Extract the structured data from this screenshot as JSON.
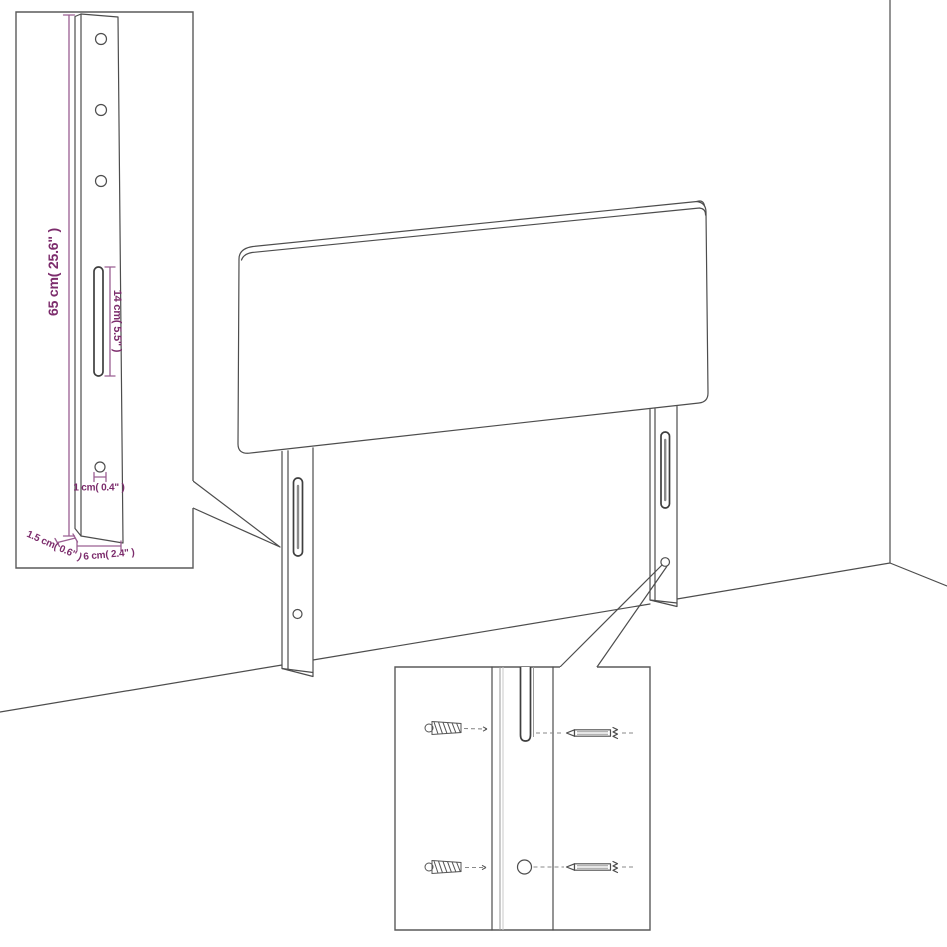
{
  "diagram": {
    "type": "furniture-assembly-diagram",
    "subject": "headboard-with-two-wall-mount-legs",
    "insets": {
      "leg_detail": {
        "dimensions": {
          "height": "65 cm( 25.6\" )",
          "slot_length": "14 cm( 5.5\" )",
          "hole_diameter": "1 cm( 0.4\" )",
          "thickness": "1.5 cm( 0.6\" )",
          "width": "6 cm( 2.4\" )"
        }
      },
      "mount_detail": {
        "icons": [
          "wall-plug-icon",
          "wall-plug-icon",
          "screw-icon",
          "screw-icon"
        ]
      }
    }
  },
  "colors": {
    "background": "#ffffff",
    "line": "#4d4d4d",
    "box_border": "#5a5a5a",
    "dimension_line": "#9a5f92",
    "dimension_text": "#7c2c6c"
  }
}
